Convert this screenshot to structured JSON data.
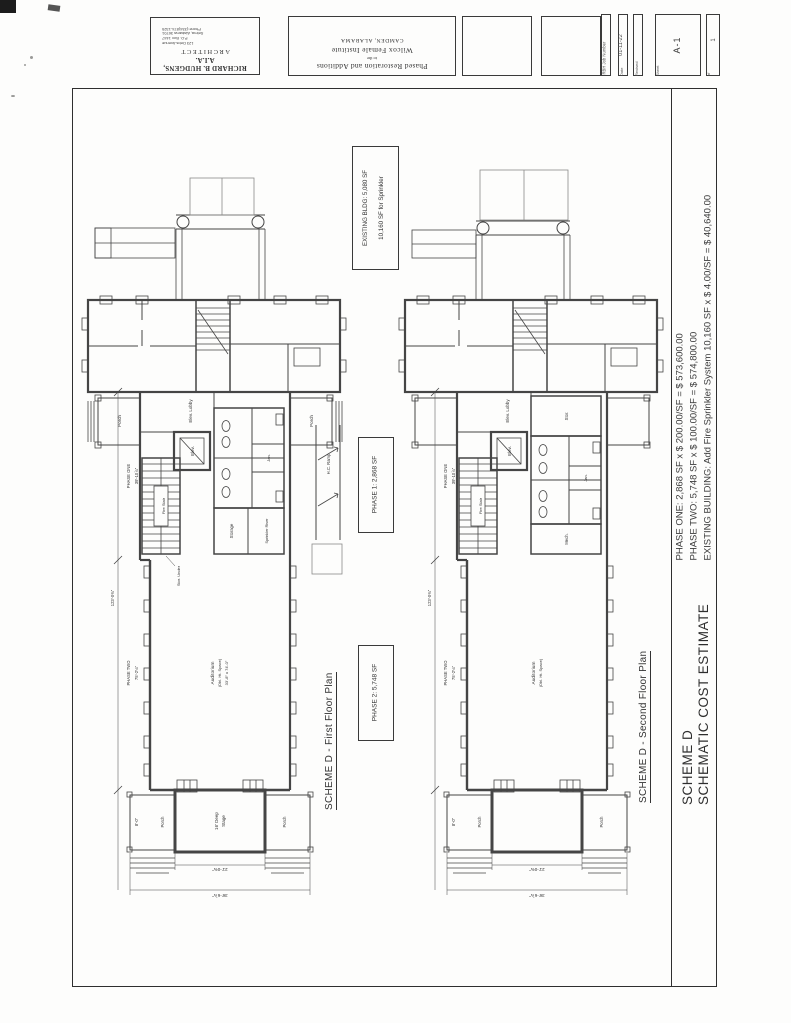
{
  "page": {
    "scheme_title": "SCHEME D",
    "scheme_subtitle": "SCHEMATIC COST ESTIMATE",
    "cost_lines": [
      "PHASE ONE: 2,868 SF x $ 200.00/SF = $ 573,600.00",
      "PHASE TWO: 5,748 SF x $ 100.00/SF = $ 574,800.00",
      "EXISTING BUILDING: Add Fire Sprinkler System 10,160 SF x $ 4.00/SF = $ 40,640.00"
    ]
  },
  "title_block": {
    "architect_name": "RICHARD B. HUDGENS, A.I.A.",
    "architect_title": "ARCHITECT",
    "address_line1": "123 Debs Avenue",
    "address_line2": "P.O. Box 1447",
    "address_line3": "Selma, Alabama 36701",
    "address_line4": "Phone:(334)874-1325",
    "project_line1": "Phased Restoration and Additions",
    "project_line2": "to the",
    "project_line3": "Wilcox Female Institute",
    "project_line4": "CAMDEN, ALABAMA",
    "job_number_label": "RBH Job Number",
    "date_label": "Date",
    "date_value": "01-11-22",
    "revised_label": "Revised",
    "sheet_label": "Sheet",
    "sheet_value": "A-1",
    "of_label": "of",
    "of_value": "1"
  },
  "first_floor": {
    "plan_title": "SCHEME D - First Floor Plan",
    "existing_note_line1": "EXISTING BLDG: 5,080 SF",
    "existing_note_line2": "10,160 SF for Sprinkler",
    "phase1_note": "PHASE 1: 2,868 SF",
    "phase2_note": "PHASE 2: 5,748 SF",
    "labels": {
      "porch": "Porch",
      "elev_lobby": "Elev. Lobby",
      "elev": "Elev.",
      "fire_stair": "Fire Stair",
      "jan": "Jan.",
      "storage": "Storage",
      "sprinkler_riser": "Sprinkler Riser",
      "stor_under": "Stor. Under",
      "hc_ramp": "H.C. Ramp",
      "auditorium": "Auditorium",
      "auditorium_sub": "(Dbl. Ht. Space)",
      "auditorium_size": "33'-8\" x 74'-0\"",
      "stage_line1": "16' Deep",
      "stage_line2": "Stage"
    },
    "dims": {
      "phase_one": "PHASE ONE",
      "phase_one_val": "39'-10⅞\"",
      "phase_two": "PHASE TWO",
      "phase_two_val": "75'-2⅛\"",
      "overall": "123'-0⅜\"",
      "porch_depth": "8'-0\"",
      "stage_width": "21'-0⅜\"",
      "overall_width": "36'-6⅞\""
    }
  },
  "second_floor": {
    "plan_title": "SCHEME D - Second Floor Plan",
    "labels": {
      "porch": "Porch",
      "elev_lobby": "Elev. Lobby",
      "elev": "Elev.",
      "fire_stair": "Fire Stair",
      "stor": "Stor.",
      "jan": "Jan.",
      "mech": "Mech.",
      "auditorium": "Auditorium",
      "auditorium_sub": "(Dbl. Ht. Space)"
    },
    "dims": {
      "phase_one": "PHASE ONE",
      "phase_one_val": "39'-10⅞\"",
      "phase_two": "PHASE TWO",
      "phase_two_val": "75'-2⅛\"",
      "overall": "123'-0⅜\"",
      "porch_depth": "8'-0\"",
      "stage_width": "21'-0⅜\"",
      "overall_width": "36'-6⅞\""
    }
  }
}
